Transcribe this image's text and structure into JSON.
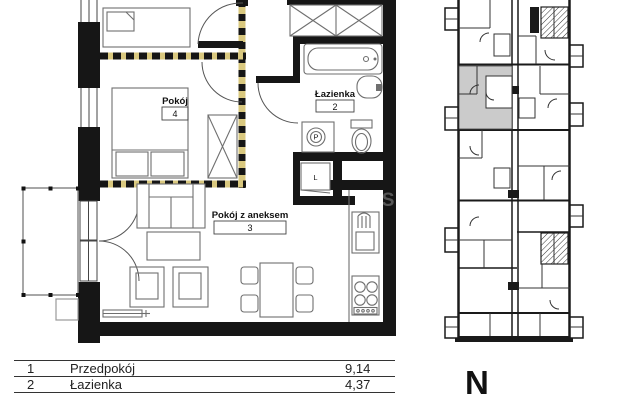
{
  "plan": {
    "room4": {
      "name": "Pokój",
      "number": "4"
    },
    "bathroom": {
      "name": "Łazienka",
      "number": "2"
    },
    "living": {
      "name": "Pokój z aneksem",
      "number": "3"
    },
    "closet_label": "L",
    "washer_label": "P"
  },
  "overview": {
    "north_label": "N"
  },
  "watermark": "RS",
  "legend_table": {
    "rows": [
      {
        "no": "1",
        "name": "Przedpokój",
        "area": "9,14"
      },
      {
        "no": "2",
        "name": "Łazienka",
        "area": "4,37"
      }
    ]
  },
  "colors": {
    "wall": "#161616",
    "furniture_stroke": "#6f6f6f",
    "dashed_accent": "#d9c87f",
    "highlight_unit": "#cbcbcb",
    "background": "#ffffff"
  }
}
